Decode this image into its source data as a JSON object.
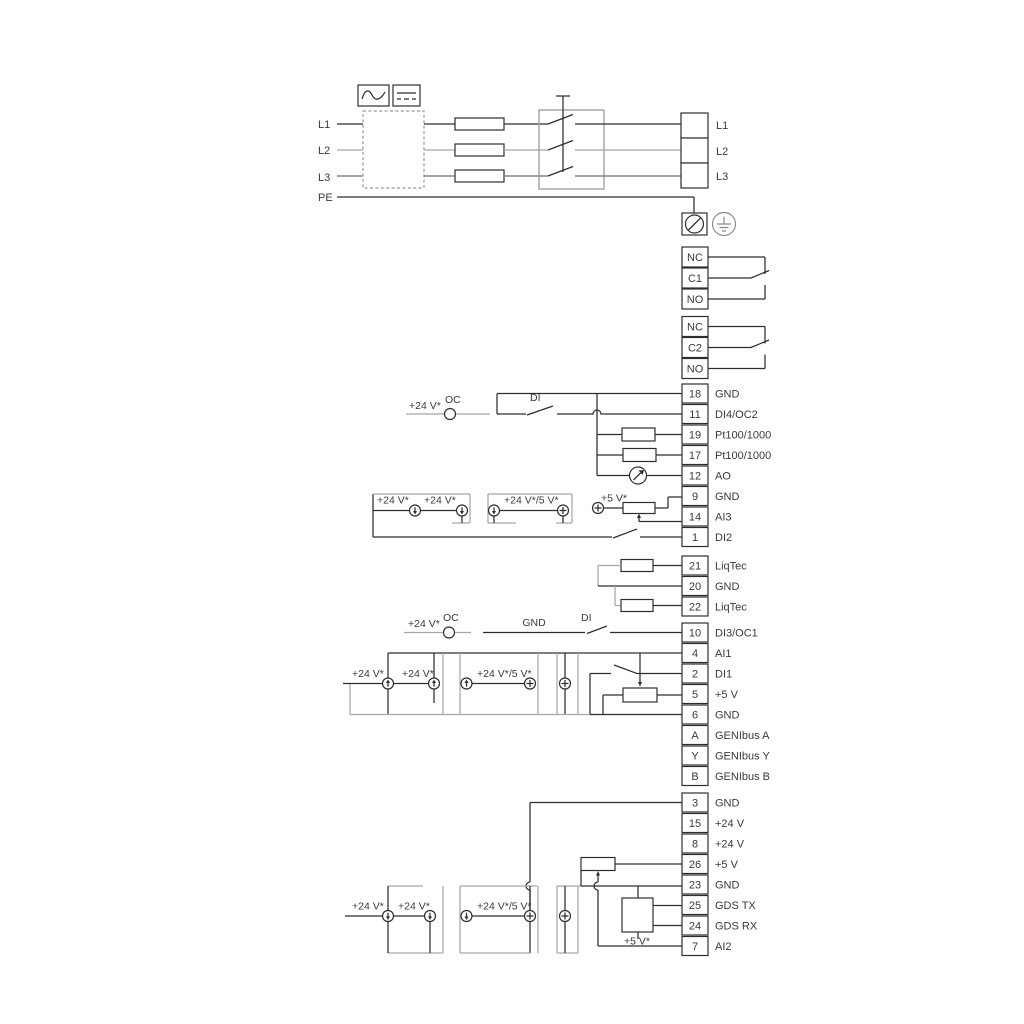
{
  "colors": {
    "dark": "#2e2e2e",
    "gray": "#a8a8a8",
    "text": "#3a3a3a"
  },
  "power": {
    "inputs": [
      "L1",
      "L2",
      "L3",
      "PE"
    ],
    "outputs": [
      "L1",
      "L2",
      "L3"
    ]
  },
  "relay1": [
    "NC",
    "C1",
    "NO"
  ],
  "relay2": [
    "NC",
    "C2",
    "NO"
  ],
  "strip1": [
    {
      "n": "18",
      "l": "GND"
    },
    {
      "n": "11",
      "l": "DI4/OC2"
    },
    {
      "n": "19",
      "l": "Pt100/1000"
    },
    {
      "n": "17",
      "l": "Pt100/1000"
    },
    {
      "n": "12",
      "l": "AO"
    },
    {
      "n": "9",
      "l": "GND"
    },
    {
      "n": "14",
      "l": "AI3"
    },
    {
      "n": "1",
      "l": "DI2"
    }
  ],
  "strip2": [
    {
      "n": "21",
      "l": "LiqTec"
    },
    {
      "n": "20",
      "l": "GND"
    },
    {
      "n": "22",
      "l": "LiqTec"
    }
  ],
  "strip3": [
    {
      "n": "10",
      "l": "DI3/OC1"
    },
    {
      "n": "4",
      "l": "AI1"
    },
    {
      "n": "2",
      "l": "DI1"
    },
    {
      "n": "5",
      "l": "+5 V"
    },
    {
      "n": "6",
      "l": "GND"
    },
    {
      "n": "A",
      "l": "GENIbus A"
    },
    {
      "n": "Y",
      "l": "GENIbus Y"
    },
    {
      "n": "B",
      "l": "GENIbus B"
    }
  ],
  "strip4": [
    {
      "n": "3",
      "l": "GND"
    },
    {
      "n": "15",
      "l": "+24 V"
    },
    {
      "n": "8",
      "l": "+24 V"
    },
    {
      "n": "26",
      "l": "+5 V"
    },
    {
      "n": "23",
      "l": "GND"
    },
    {
      "n": "25",
      "l": "GDS TX"
    },
    {
      "n": "24",
      "l": "GDS RX"
    },
    {
      "n": "7",
      "l": "AI2"
    }
  ],
  "ann": {
    "v24": "+24 V*",
    "v24_5": "+24 V*/5 V*",
    "v5": "+5 V*",
    "oc": "OC",
    "di": "DI",
    "gnd": "GND"
  }
}
